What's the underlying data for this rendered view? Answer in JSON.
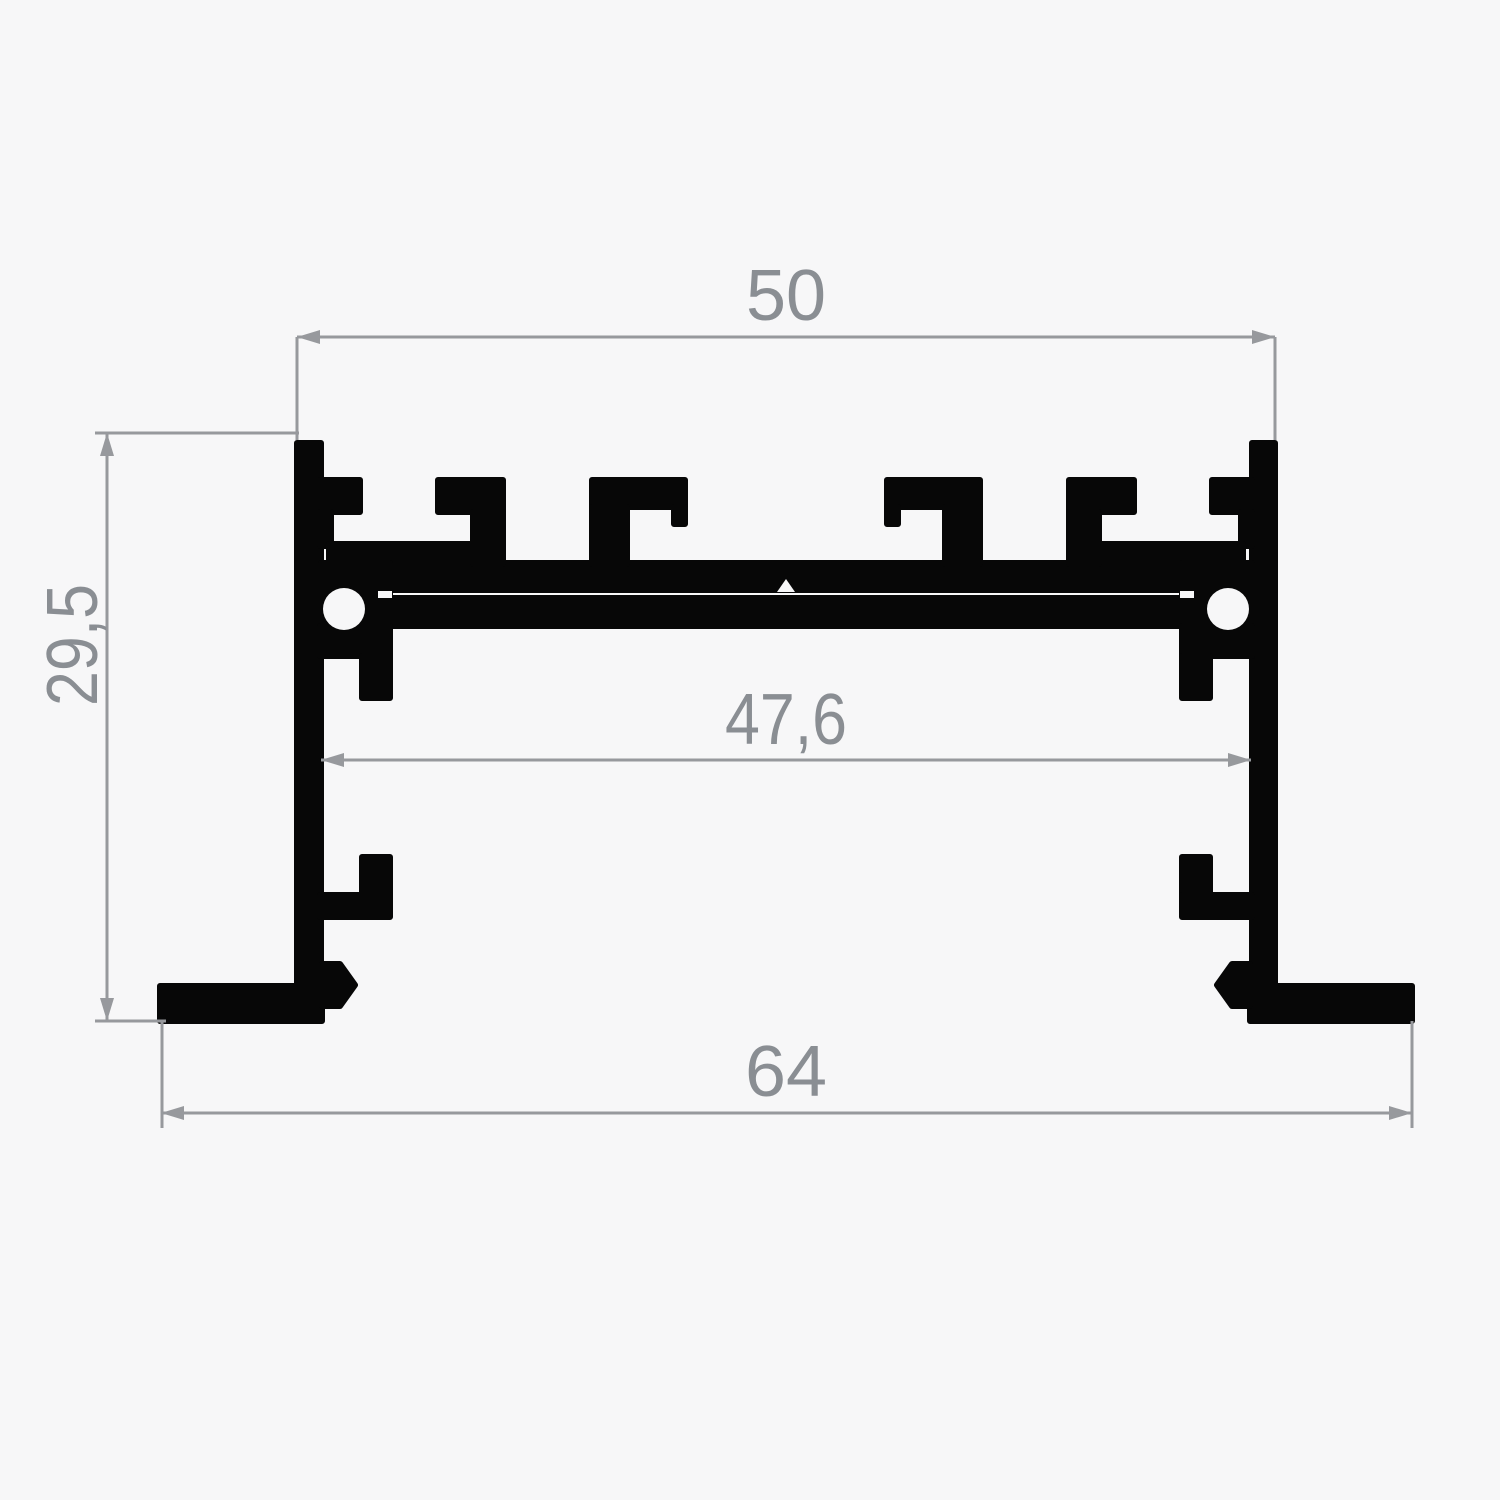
{
  "drawing": {
    "kind_label": "aluminium-profile-cross-section",
    "dimensions": {
      "top_width": "50",
      "inner_width": "47,6",
      "height": "29,5",
      "bottom_width": "64"
    },
    "colors": {
      "profile": "#070707",
      "dimension_line": "#97999d",
      "dimension_text": "#8a8e93",
      "background": "#f7f7f8"
    }
  }
}
